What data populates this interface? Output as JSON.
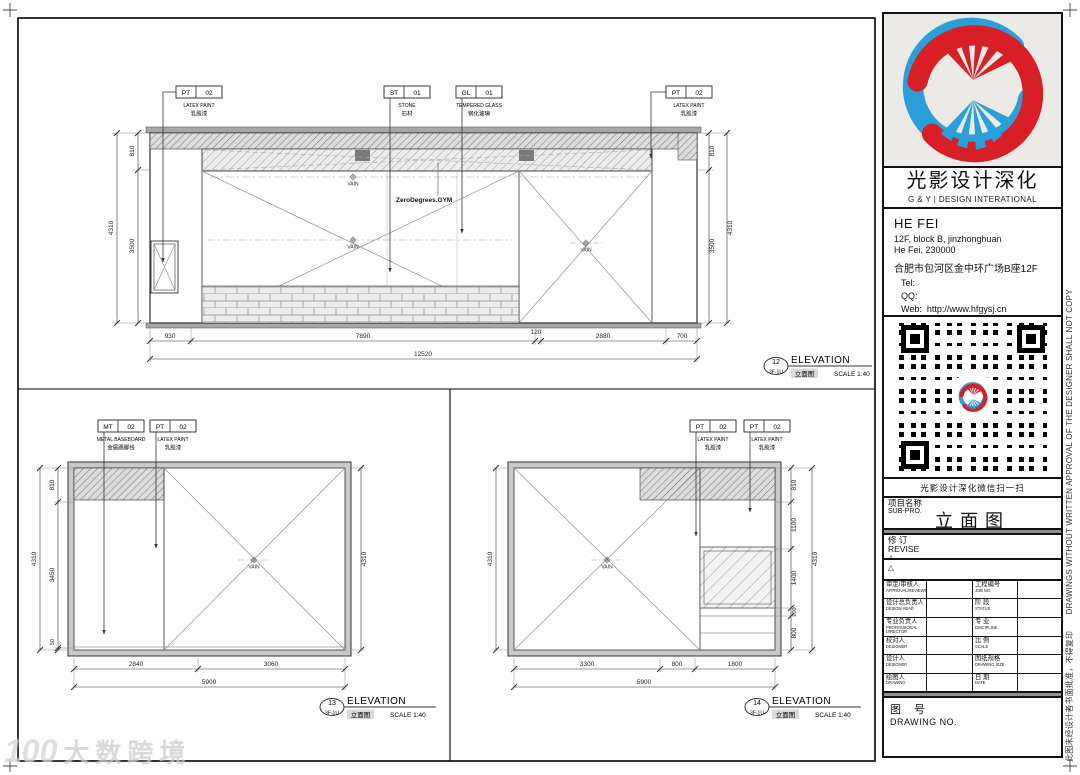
{
  "sheet": {
    "watermark_logo": "100",
    "watermark_text": "大数跨境",
    "side_note": "此图未经设计者书面批准，不得复印　　DRAWINGS WITHOUT WRITTEN APPROVAL OF THE DESIGNER SHALL NOT COPY"
  },
  "title_block": {
    "company_cn": "光影设计深化",
    "company_en": "G & Y | DESIGN INTERATIONAL",
    "office_city": "HE FEI",
    "office_addr1": "12F, block B, jinzhonghuan",
    "office_addr2": "He Fei, 230000",
    "office_addr_cn": "合肥市包河区金中环广场B座12F",
    "tel_label": "Tel:",
    "qq_label": "QQ:",
    "web_label": "Web:",
    "web_url": "http://www.hfgysj.cn",
    "qr_caption": "光影设计深化微信扫一扫",
    "project_label_cn": "项目名称",
    "project_label_en": "SUB-PRO.",
    "project_name": "立面图",
    "revise_cn": "修 订",
    "revise_en": "REVISE",
    "revise_symbol": "△",
    "rows": [
      {
        "c1cn": "审定/审核人",
        "c1en": "APPROVAL/REVIEWER",
        "c2cn": "工程编号",
        "c2en": "JOB NO."
      },
      {
        "c1cn": "设计总负责人",
        "c1en": "DESIGN HEAD",
        "c2cn": "阶 段",
        "c2en": "STATUS"
      },
      {
        "c1cn": "专业负责人",
        "c1en": "PROFESSIONAL DIRECTOR",
        "c2cn": "专 业",
        "c2en": "DISCIPLINE"
      },
      {
        "c1cn": "校对人",
        "c1en": "DESIGNER",
        "c2cn": "比 例",
        "c2en": "SCALE"
      },
      {
        "c1cn": "设计人",
        "c1en": "DESIGNER",
        "c2cn": "图纸规格",
        "c2en": "DRAWING SIZE"
      },
      {
        "c1cn": "绘图人",
        "c1en": "DRAWING",
        "c2cn": "日 期",
        "c2en": "DATE"
      }
    ],
    "drawing_no_cn": "图 号",
    "drawing_no_en": "DRAWING NO."
  },
  "e12": {
    "no": "12",
    "ref": "3F-1U",
    "title": "ELEVATION",
    "title_cn": "立面图",
    "scale": "SCALE 1:40",
    "mark": "VAIN",
    "sign": "ZeroDegrees.GYM",
    "labels": [
      {
        "c": "PT",
        "n": "02",
        "en": "LATEX PAINT",
        "cn": "乳胶漆"
      },
      {
        "c": "ST",
        "n": "01",
        "en": "STONE",
        "cn": "石材"
      },
      {
        "c": "GL",
        "n": "01",
        "en": "TEMPERED GLASS",
        "cn": "钢化玻璃"
      },
      {
        "c": "PT",
        "n": "02",
        "en": "LATEX PAINT",
        "cn": "乳胶漆"
      }
    ],
    "bot": [
      "930",
      "7890",
      "120",
      "2880",
      "700"
    ],
    "total": "12520",
    "side": [
      "810",
      "3500"
    ],
    "height": "4310"
  },
  "e13": {
    "no": "13",
    "ref": "3F-1U",
    "title": "ELEVATION",
    "title_cn": "立面图",
    "scale": "SCALE 1:40",
    "mark": "VAIN",
    "labels": [
      {
        "c": "MT",
        "n": "02",
        "en": "METAL BASEBOARD",
        "cn": "金属踢脚线"
      },
      {
        "c": "PT",
        "n": "02",
        "en": "LATEX PAINT",
        "cn": "乳胶漆"
      }
    ],
    "bot": [
      "2840",
      "3060"
    ],
    "total": "5900",
    "side": [
      "810",
      "3450",
      "50"
    ],
    "height": "4310"
  },
  "e14": {
    "no": "14",
    "ref": "3F-1U",
    "title": "ELEVATION",
    "title_cn": "立面图",
    "scale": "SCALE 1:40",
    "mark": "VAIN",
    "labels": [
      {
        "c": "PT",
        "n": "02",
        "en": "LATEX PAINT",
        "cn": "乳胶漆"
      },
      {
        "c": "PT",
        "n": "02",
        "en": "LATEX PAINT",
        "cn": "乳胶漆"
      }
    ],
    "bot": [
      "3300",
      "800",
      "1800"
    ],
    "total": "5900",
    "side": [
      "810",
      "1100",
      "1400",
      "200",
      "800"
    ],
    "height": "4310"
  }
}
